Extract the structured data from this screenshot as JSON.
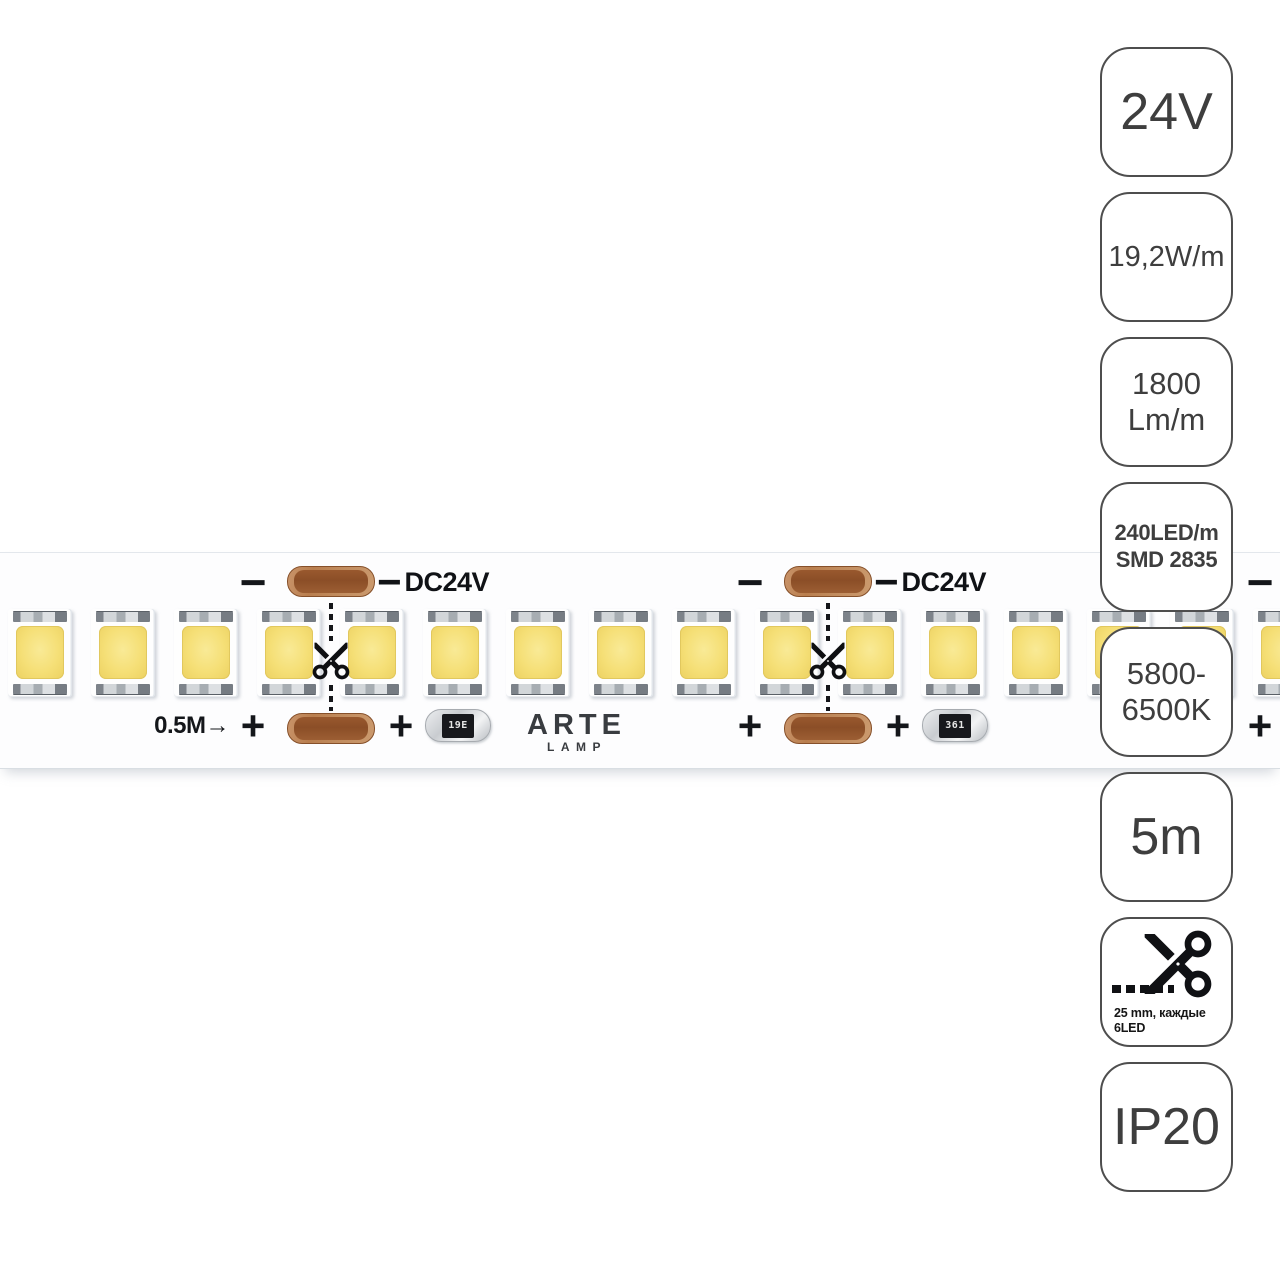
{
  "brand": {
    "line1": "ARTE",
    "line2": "LAMP"
  },
  "strip": {
    "voltage_label": "DC24V",
    "minus_symbol": "−",
    "plus_symbol": "+",
    "segment_length_label": "0.5M→",
    "resistor_markings": [
      "19E",
      "361"
    ],
    "led_count": 16,
    "colors": {
      "led_yellow": "#f5df76",
      "copper_pad": "#8b4e27",
      "badge_border": "#4e4e4e",
      "badge_text": "#3e3e3e"
    }
  },
  "badges": [
    {
      "name": "voltage",
      "lines": [
        "24V"
      ]
    },
    {
      "name": "power",
      "lines": [
        "19,2W/m"
      ]
    },
    {
      "name": "luminous-flux",
      "lines": [
        "1800",
        "Lm/m"
      ]
    },
    {
      "name": "led-density",
      "lines": [
        "240LED/m",
        "SMD 2835"
      ]
    },
    {
      "name": "color-temperature",
      "lines": [
        "5800-",
        "6500K"
      ]
    },
    {
      "name": "length",
      "lines": [
        "5m"
      ]
    },
    {
      "name": "cut-step",
      "icon": "scissors-icon",
      "lines": [
        "25 mm, каждые",
        "6LED"
      ]
    },
    {
      "name": "ip-rating",
      "lines": [
        "IP20"
      ]
    }
  ]
}
